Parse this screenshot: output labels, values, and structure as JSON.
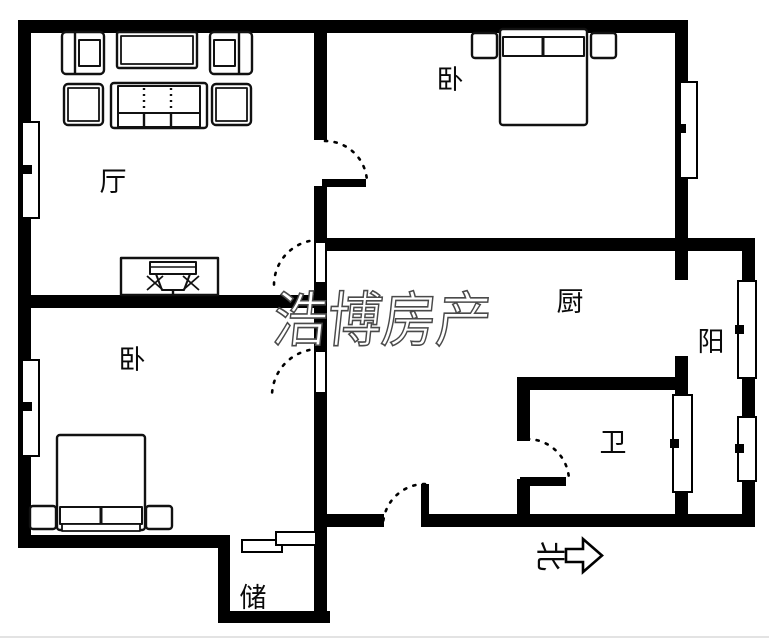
{
  "title": "apartment-floor-plan",
  "watermark": {
    "text": "浩博房产"
  },
  "compass": {
    "label": "北"
  },
  "rooms": {
    "living": {
      "label": "厅"
    },
    "bedroom_top": {
      "label": "卧"
    },
    "bedroom_bottom": {
      "label": "卧"
    },
    "kitchen": {
      "label": "厨"
    },
    "balcony": {
      "label": "阳"
    },
    "bathroom": {
      "label": "卫"
    },
    "storage": {
      "label": "储"
    }
  },
  "colors": {
    "wall": "#000000",
    "background": "#ffffff",
    "watermark_fill": "#ffffff",
    "watermark_outline": "#4a4a4a",
    "furniture_stroke": "#111111"
  }
}
